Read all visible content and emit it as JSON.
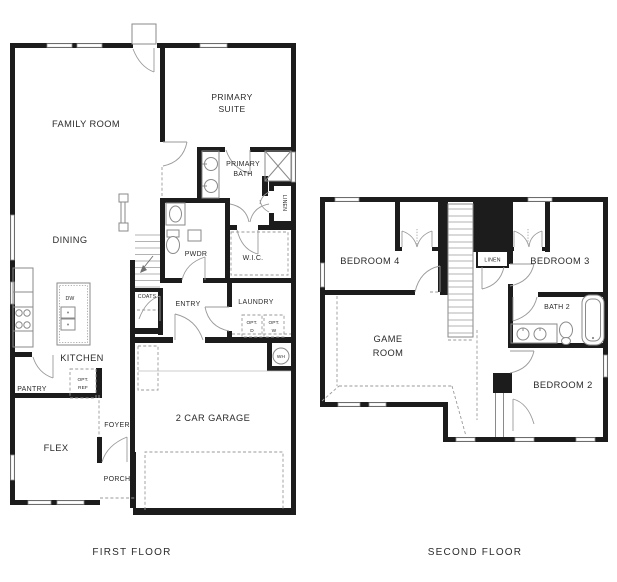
{
  "colors": {
    "wall": "#1c1c1c",
    "fixture_line": "#8a8a8a",
    "dashed_line": "#9a9a9a",
    "text": "#2b2b2b",
    "background": "#ffffff"
  },
  "first_floor": {
    "caption": "FIRST FLOOR",
    "labels": {
      "family_room": "FAMILY ROOM",
      "primary_suite_1": "PRIMARY",
      "primary_suite_2": "SUITE",
      "primary_bath_1": "PRIMARY",
      "primary_bath_2": "BATH",
      "linen": "LINEN",
      "dining": "DINING",
      "pwdr": "PWDR",
      "wic": "W.I.C.",
      "coats": "COATS",
      "entry": "ENTRY",
      "laundry": "LAUNDRY",
      "opt_d_1": "OPT.",
      "opt_d_2": "D",
      "opt_w_1": "OPT.",
      "opt_w_2": "W",
      "kitchen": "KITCHEN",
      "dw": "DW",
      "pantry": "PANTRY",
      "opt_ref_1": "OPT.",
      "opt_ref_2": "REF",
      "flex": "FLEX",
      "foyer": "FOYER",
      "porch": "PORCH",
      "garage": "2 CAR GARAGE",
      "wh": "WH"
    }
  },
  "second_floor": {
    "caption": "SECOND FLOOR",
    "labels": {
      "bedroom4": "BEDROOM 4",
      "bedroom3": "BEDROOM 3",
      "linen": "LINEN",
      "game_room_1": "GAME",
      "game_room_2": "ROOM",
      "bath2": "BATH 2",
      "bedroom2": "BEDROOM 2"
    }
  }
}
